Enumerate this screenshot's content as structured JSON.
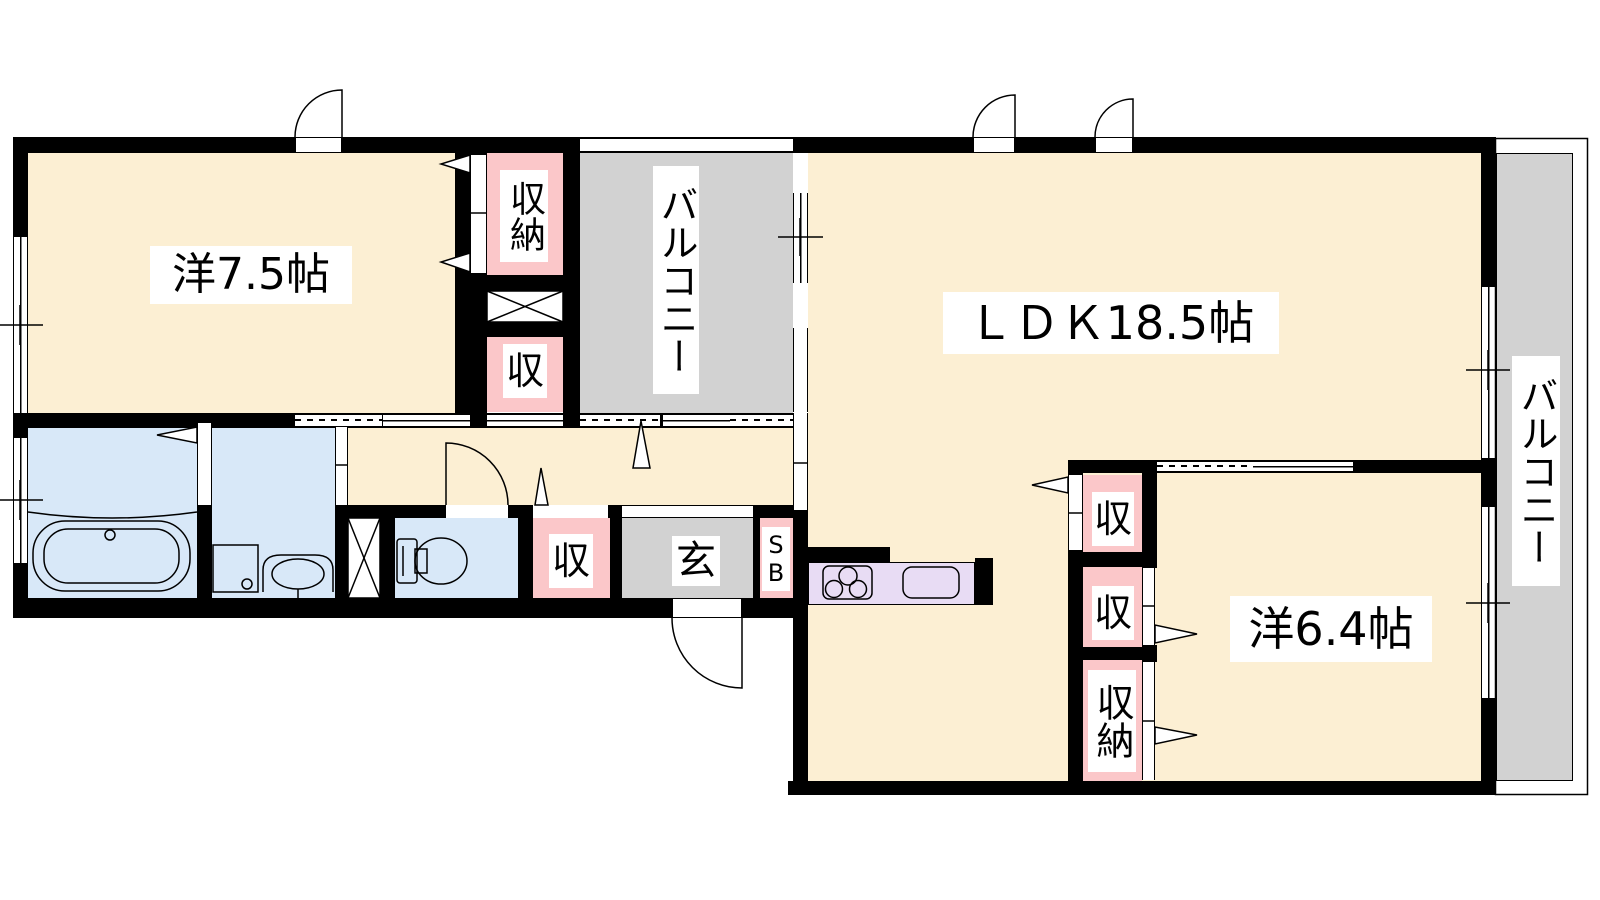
{
  "rooms": {
    "western1": {
      "label": "洋7.5帖"
    },
    "ldk": {
      "label": "ＬＤＫ18.5帖"
    },
    "western2": {
      "label": "洋6.4帖"
    },
    "balcony_top": {
      "label": "バルコニー"
    },
    "balcony_right": {
      "label": "バルコニー"
    },
    "entrance": {
      "label": "玄"
    },
    "shoebox": {
      "label": "SB"
    },
    "closet_nw": {
      "label": "収納"
    },
    "closet_w": {
      "label": "収"
    },
    "closet_hall": {
      "label": "収"
    },
    "closet_e_top": {
      "label": "収"
    },
    "closet_e_mid": {
      "label": "収"
    },
    "closet_se": {
      "label": "収納"
    }
  },
  "colors": {
    "room_floor": "#FCEFD3",
    "closet_pink": "#FBC7C9",
    "balcony_gray": "#D2D2D2",
    "wet_area_blue": "#D8E8F8",
    "kitchen_counter": "#E8DCF4",
    "wall": "#000000"
  }
}
